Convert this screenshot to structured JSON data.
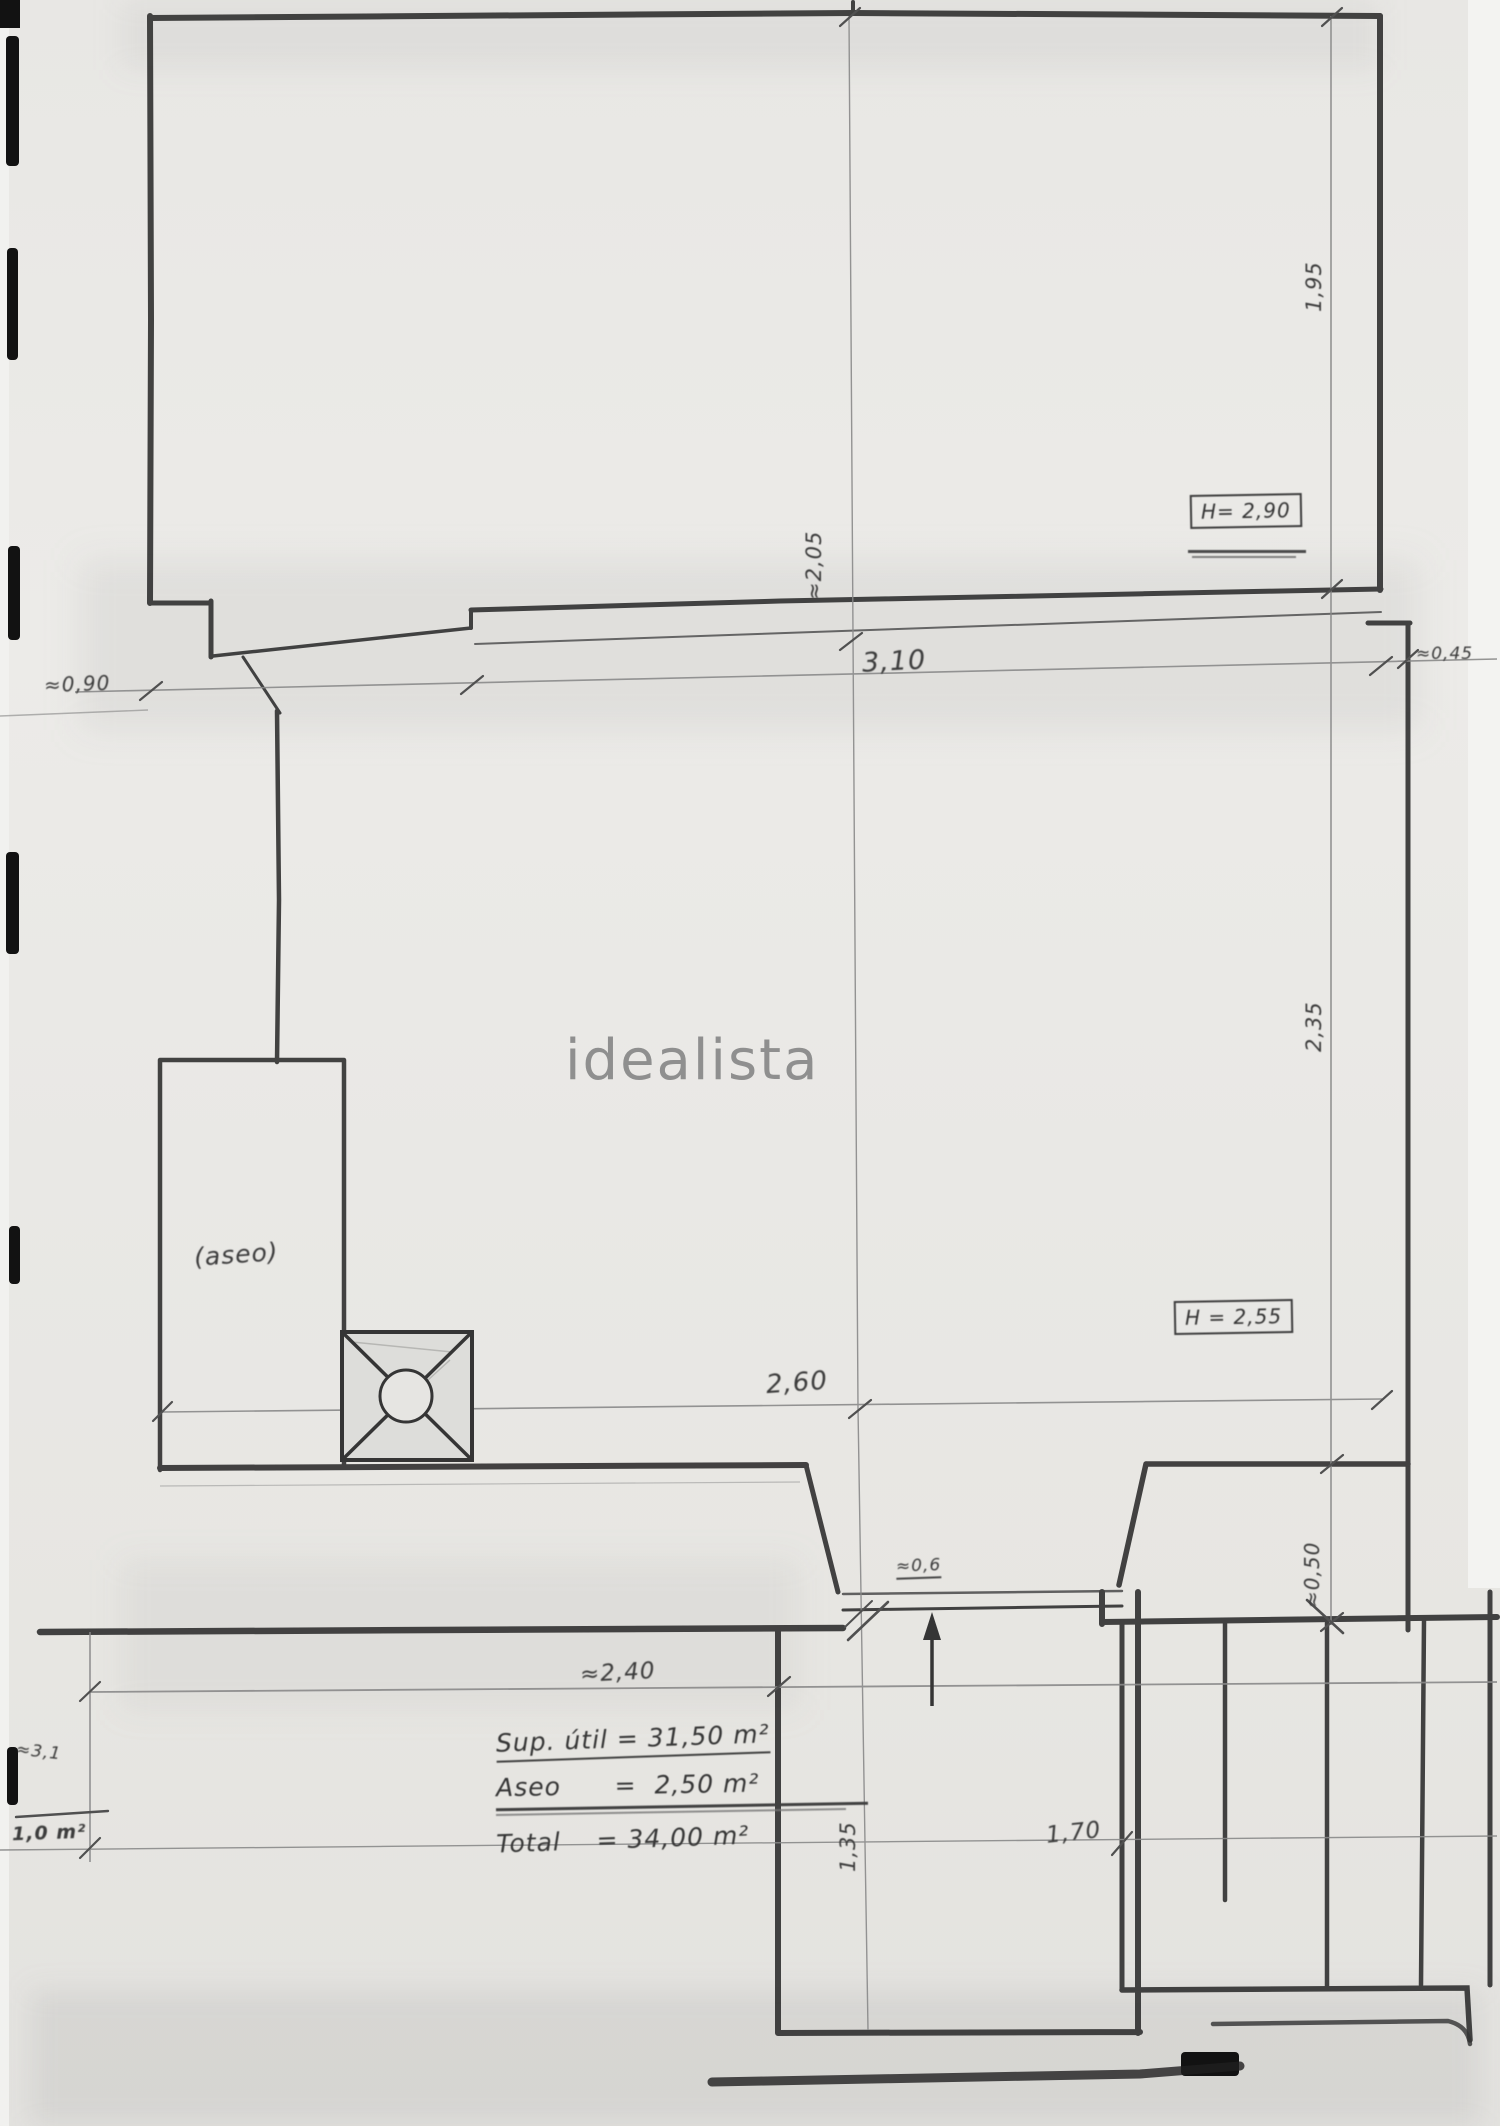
{
  "watermark": "idealista",
  "colors": {
    "paper": "#e9e8e5",
    "ink": "#333333",
    "pencil": "#8a8a8a",
    "watermark_gray": "#8f8f8f"
  },
  "rooms": {
    "toilet_label": "(aseo)"
  },
  "height_notes": {
    "upper": "H= 2,90",
    "lower": "H = 2,55"
  },
  "dimensions": {
    "top_width": "3,10",
    "top_left": "≈0,90",
    "top_right": "≈0,45",
    "upper_vertical": "≈2,05",
    "right_upper": "1,95",
    "right_middle": "2,35",
    "right_lower": "≈0,50",
    "room_width": "2,60",
    "corridor_width": "≈2,40",
    "stair_width": "1,70",
    "stairwell_depth": "1,35",
    "door_width": "≈0,6"
  },
  "area_summary": {
    "line1": "Sup. útil = 31,50 m²",
    "line2": "Aseo      =  2,50 m²",
    "line3": "Total    = 34,00 m²"
  },
  "margin_note": {
    "top": "≈3,1",
    "bottom": "1,0 m²"
  }
}
